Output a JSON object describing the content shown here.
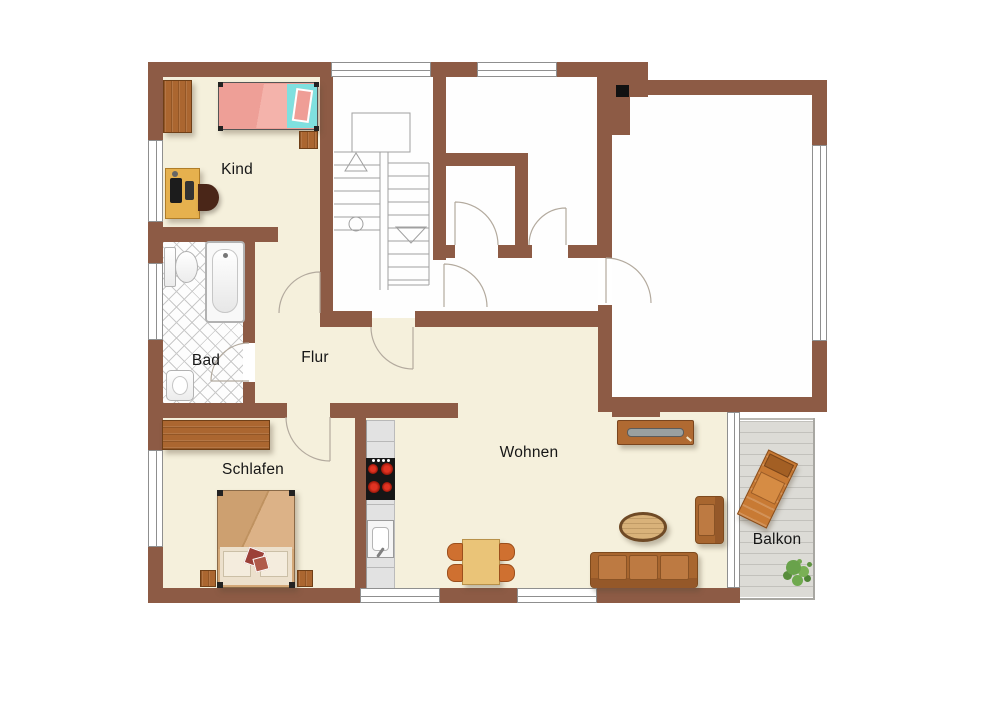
{
  "title": "apartment-floor-plan",
  "rooms": {
    "kind": {
      "label": "Kind"
    },
    "bad": {
      "label": "Bad"
    },
    "flur": {
      "label": "Flur"
    },
    "schlafen": {
      "label": "Schlafen"
    },
    "wohnen": {
      "label": "Wohnen"
    },
    "balkon": {
      "label": "Balkon"
    }
  },
  "colors": {
    "wall": "#8d5b45",
    "floor": "#f5f0dc",
    "wet_room_floor": "#fdfdfd",
    "balcony_deck": "#dcdbd6",
    "wood_furniture": "#ab6630",
    "child_bed_blanket": "#ee9f97",
    "child_bed_sheet": "#7fe0df",
    "sofa": "#b26f38",
    "stove_burner": "#cc2200",
    "plant": "#5f9440",
    "label_text": "#161616"
  },
  "symbols": [
    "stairs",
    "chimney",
    "single-bed",
    "wardrobe",
    "desk",
    "desk-chair",
    "toilet",
    "bathtub",
    "washbasin",
    "double-bed",
    "nightstand",
    "kitchenette",
    "cooktop",
    "kitchen-sink",
    "dining-table",
    "dining-chair",
    "sideboard",
    "coffee-table",
    "sofa",
    "armchair",
    "lounge-chair",
    "plant"
  ]
}
